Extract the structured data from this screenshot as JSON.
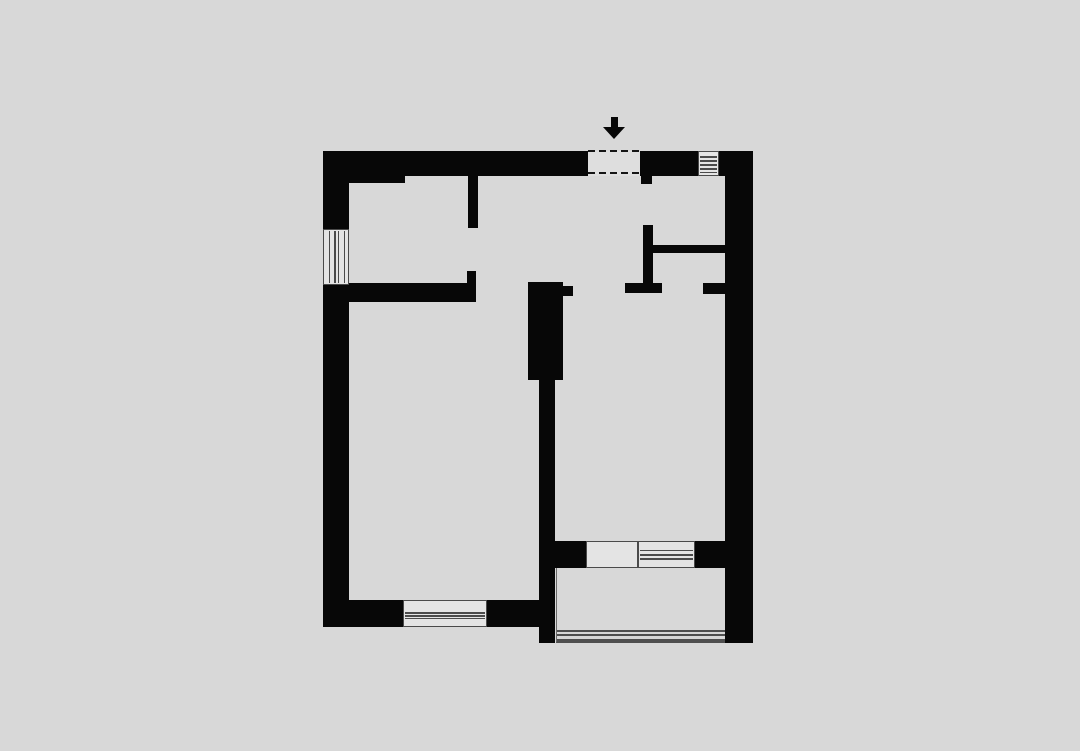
{
  "meta": {
    "description": "architectural-floor-plan-one-bedroom-apartment",
    "canvas": {
      "width": 1080,
      "height": 751,
      "background": "#d8d8d8"
    }
  },
  "colors": {
    "wall": "#070707",
    "window_fill": "#e4e4e4",
    "window_line": "#4a4a4a",
    "opening_fill": "#dedede",
    "dash": "#141414",
    "rail": "#4f4f4f",
    "balcony_fill": "#d8d8d8",
    "balcony_edge": "#6a6a6a"
  },
  "floorplan": {
    "walls": [
      {
        "name": "wall-top-left",
        "x": 323,
        "y": 151,
        "w": 265,
        "h": 25
      },
      {
        "name": "wall-top-left-thick",
        "x": 323,
        "y": 151,
        "w": 82,
        "h": 32
      },
      {
        "name": "wall-top-mid",
        "x": 640,
        "y": 151,
        "w": 58,
        "h": 25
      },
      {
        "name": "wall-top-right",
        "x": 719,
        "y": 151,
        "w": 34,
        "h": 25
      },
      {
        "name": "wall-right",
        "x": 725,
        "y": 151,
        "w": 28,
        "h": 492
      },
      {
        "name": "wall-left-upper",
        "x": 323,
        "y": 151,
        "w": 26,
        "h": 78
      },
      {
        "name": "wall-left-lower",
        "x": 323,
        "y": 285,
        "w": 26,
        "h": 342
      },
      {
        "name": "wall-bottom-left",
        "x": 323,
        "y": 600,
        "w": 80,
        "h": 27
      },
      {
        "name": "wall-bottom-right",
        "x": 487,
        "y": 600,
        "w": 68,
        "h": 27
      },
      {
        "name": "entry-door-stub",
        "x": 641,
        "y": 176,
        "w": 11,
        "h": 8
      },
      {
        "name": "partition-room1-upper",
        "x": 468,
        "y": 176,
        "w": 10,
        "h": 52
      },
      {
        "name": "partition-room1-lower",
        "x": 467,
        "y": 271,
        "w": 9,
        "h": 31
      },
      {
        "name": "wall-room1-bottom",
        "x": 349,
        "y": 283,
        "w": 126,
        "h": 19
      },
      {
        "name": "central-column",
        "x": 528,
        "y": 282,
        "w": 35,
        "h": 98
      },
      {
        "name": "central-column-notch",
        "x": 563,
        "y": 286,
        "w": 10,
        "h": 10
      },
      {
        "name": "wall-central-vertical",
        "x": 539,
        "y": 380,
        "w": 16,
        "h": 263
      },
      {
        "name": "wall-closet-vertical",
        "x": 643,
        "y": 225,
        "w": 10,
        "h": 68
      },
      {
        "name": "wall-doorway-stub-left",
        "x": 625,
        "y": 283,
        "w": 37,
        "h": 10
      },
      {
        "name": "wall-doorway-stub-right",
        "x": 703,
        "y": 283,
        "w": 22,
        "h": 11
      },
      {
        "name": "wall-closet-bottom",
        "x": 653,
        "y": 245,
        "w": 74,
        "h": 8
      },
      {
        "name": "wall-balcony-band-left",
        "x": 555,
        "y": 541,
        "w": 31,
        "h": 27
      },
      {
        "name": "wall-balcony-band-right",
        "x": 695,
        "y": 541,
        "w": 30,
        "h": 27
      }
    ],
    "windows": [
      {
        "name": "window-top",
        "x": 698,
        "y": 151,
        "w": 21,
        "h": 25,
        "dir": "h",
        "line_pos": [
          0.18,
          0.36,
          0.53,
          0.7,
          0.85
        ]
      },
      {
        "name": "window-left",
        "x": 323,
        "y": 229,
        "w": 26,
        "h": 56,
        "dir": "v",
        "line_pos": [
          0.2,
          0.42,
          0.58,
          0.82
        ]
      },
      {
        "name": "window-bottom",
        "x": 403,
        "y": 600,
        "w": 84,
        "h": 27,
        "dir": "h",
        "line_pos": [
          0.45,
          0.56,
          0.67
        ]
      },
      {
        "name": "window-right-room",
        "x": 638,
        "y": 541,
        "w": 57,
        "h": 27,
        "dir": "h",
        "line_pos": [
          0.3,
          0.48,
          0.64
        ]
      },
      {
        "name": "balcony-door",
        "x": 586,
        "y": 541,
        "w": 52,
        "h": 27,
        "dir": "h",
        "line_pos": []
      }
    ],
    "entrance": {
      "opening": {
        "name": "entrance-opening",
        "x": 588,
        "y": 151,
        "w": 52,
        "h": 25
      },
      "dashes": [
        {
          "name": "entrance-dash-top",
          "x": 588,
          "y": 150,
          "w": 53
        },
        {
          "name": "entrance-dash-bottom",
          "x": 588,
          "y": 172,
          "w": 54
        }
      ],
      "arrow": {
        "name": "entrance-arrow",
        "shaft": {
          "x": 611,
          "y": 117,
          "w": 7,
          "h": 11
        },
        "head": {
          "cx": 614,
          "y": 127,
          "h": 12,
          "half_w": 11
        }
      }
    },
    "balcony": {
      "name": "balcony",
      "x": 556,
      "y": 568,
      "w": 169,
      "h": 75,
      "rail_offsets": [
        62,
        66,
        71
      ]
    }
  }
}
